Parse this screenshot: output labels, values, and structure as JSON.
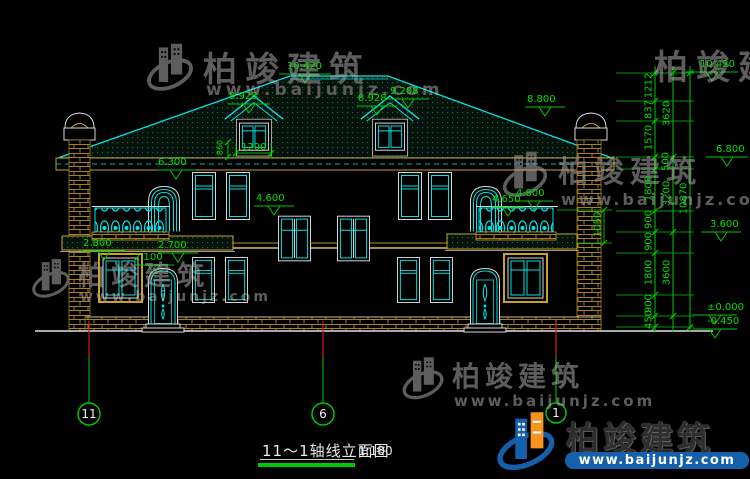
{
  "title": {
    "name": "11～1轴线立面图",
    "scale": "1:100"
  },
  "axes": {
    "a11": "11",
    "a6": "6",
    "a1": "1"
  },
  "elevations": {
    "ridge": "10.420",
    "dormer_l": "8.928",
    "dormer_r_eave": "8.928",
    "dormer_r_ridge": "9.208",
    "chimney_r": "8.800",
    "eave": "6.300",
    "f2_sill": "4.600",
    "balcony_r_a": "4.650",
    "balcony_r_b": "4.800",
    "awning_l": "2.800",
    "awning_r": "2.700",
    "door_head": "2.100",
    "right_top": "10.420",
    "right_68": "6.800",
    "right_36": "3.600",
    "right_zero": "±0.000",
    "right_neg": "-0.450"
  },
  "dims": {
    "dormer_width": "1200",
    "dormer_sill": "860",
    "balcony_rail": "1050",
    "chain_col1": [
      "1212",
      "837",
      "1570",
      "500",
      "1800",
      "900",
      "900",
      "1800",
      "900",
      "450"
    ],
    "chain_col2": [
      "3620",
      "3200",
      "3600"
    ],
    "chain_total": "10870"
  },
  "watermark": {
    "brand": "柏竣建筑",
    "site": "www.baijunjz.com"
  },
  "brand": {
    "name": "柏竣建筑",
    "site": "www.baijunjz.com"
  }
}
